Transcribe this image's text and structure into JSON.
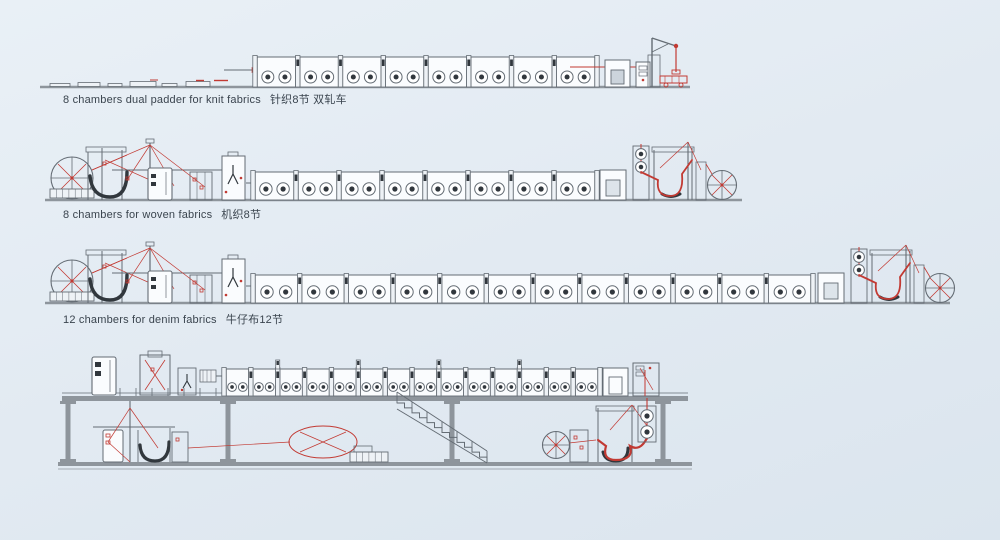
{
  "colors": {
    "background_top": "#e9f0f6",
    "background_bottom": "#dbe5ee",
    "line": "#646c74",
    "dark": "#31373d",
    "red": "#c23a33",
    "base": "#8e959c",
    "fill": "#fafcfe",
    "light": "#eef2f6",
    "text": "#3a444e"
  },
  "lines": [
    {
      "name": "knit-line",
      "label": "8 chambers dual padder for knit fabrics",
      "label_cn": "针织8节 双轧车",
      "chambers": 8
    },
    {
      "name": "woven-line",
      "label": "8 chambers for woven fabrics",
      "label_cn": "机织8节",
      "chambers": 8
    },
    {
      "name": "denim-line",
      "label": "12 chambers for denim fabrics",
      "label_cn": "牛仔布12节",
      "chambers": 12
    },
    {
      "name": "elevated-line",
      "label": "",
      "label_cn": "",
      "chambers": 14
    }
  ]
}
